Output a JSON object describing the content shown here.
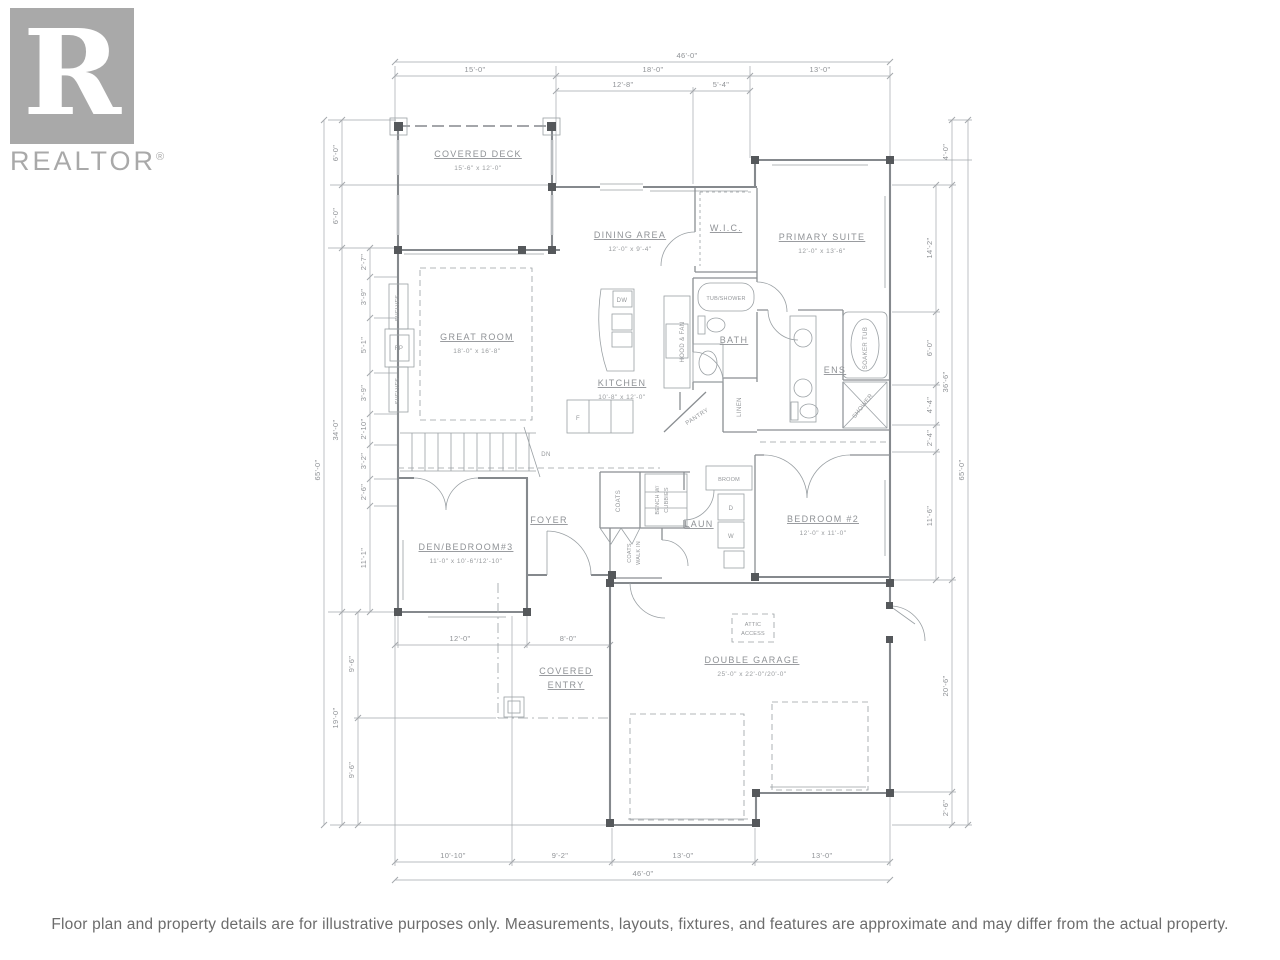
{
  "branding": {
    "logo_letter": "R",
    "logo_text": "REALTOR",
    "reg": "®"
  },
  "plan": {
    "rooms": {
      "covered_deck": {
        "name": "COVERED DECK",
        "dims": "15'-6\" x 12'-0\""
      },
      "dining": {
        "name": "DINING AREA",
        "dims": "12'-0\" x 9'-4\""
      },
      "wic": {
        "name": "W.I.C."
      },
      "primary": {
        "name": "PRIMARY SUITE",
        "dims": "12'-0\" x 13'-6\""
      },
      "great": {
        "name": "GREAT ROOM",
        "dims": "18'-0\" x 16'-8\""
      },
      "kitchen": {
        "name": "KITCHEN",
        "dims": "10'-8\" x 12'-0\""
      },
      "bath": {
        "name": "BATH"
      },
      "ens": {
        "name": "ENS"
      },
      "foyer": {
        "name": "FOYER"
      },
      "laun": {
        "name": "LAUN"
      },
      "den": {
        "name": "DEN/BEDROOM#3",
        "dims": "11'-0\" x 10'-6\"/12'-10\""
      },
      "bed2": {
        "name": "BEDROOM #2",
        "dims": "12'-0\" x 11'-0\""
      },
      "covered_entry": {
        "line1": "COVERED",
        "line2": "ENTRY"
      },
      "garage": {
        "name": "DOUBLE GARAGE",
        "dims": "25'-0\" x 22'-0\"/20'-0\""
      }
    },
    "fixtures": {
      "tub_shower": "TUB/SHOWER",
      "soaker_tub": "SOAKER TUB",
      "shower": "SHOWER",
      "linen": "LINEN",
      "pantry": "PANTRY",
      "hood_fan": "HOOD & FAN",
      "dw": "DW",
      "fp": "FP",
      "shelves": "SHELVES",
      "coats": "COATS",
      "bench_1": "BENCH W/",
      "bench_2": "CUBBIES",
      "walkin_1": "COATS",
      "walkin_2": "WALK IN",
      "broom": "BROOM",
      "dryer": "D",
      "washer": "W",
      "dn": "DN",
      "attic_1": "ATTIC",
      "attic_2": "ACCESS",
      "fridge": "F"
    },
    "dims": {
      "top": {
        "total": "46'-0\"",
        "seg": [
          "15'-0\"",
          "18'-0\"",
          "13'-0\""
        ],
        "sub": [
          "12'-8\"",
          "5'-4\""
        ]
      },
      "bottom": {
        "seg": [
          "10'-10\"",
          "9'-2\"",
          "13'-0\"",
          "13'-0\""
        ],
        "total": "46'-0\""
      },
      "left": {
        "total": "65'-0\"",
        "mid": [
          "6'-0\"",
          "6'-0\"",
          "34'-0\"",
          "19'-0\""
        ],
        "inner": [
          "9'-6\"",
          "9'-6\""
        ],
        "small": [
          "2'-7\"",
          "3'-9\"",
          "5'-1\"",
          "3'-9\"",
          "2'-10\"",
          "3'-2\"",
          "2'-6\"",
          "11'-1\""
        ]
      },
      "right": {
        "total": "65'-0\"",
        "mid": [
          "4'-0\"",
          "36'-6\"",
          "20'-6\"",
          "2'-6\""
        ],
        "inner": [
          "14'-2\"",
          "6'-0\"",
          "4'-4\"",
          "2'-4\"",
          "11'-6\""
        ]
      },
      "entry": [
        "12'-0\"",
        "8'-0\""
      ]
    }
  },
  "disclaimer": "Floor plan and property details are for illustrative purposes only. Measurements, layouts, fixtures, and features are approximate and may differ from the actual property."
}
